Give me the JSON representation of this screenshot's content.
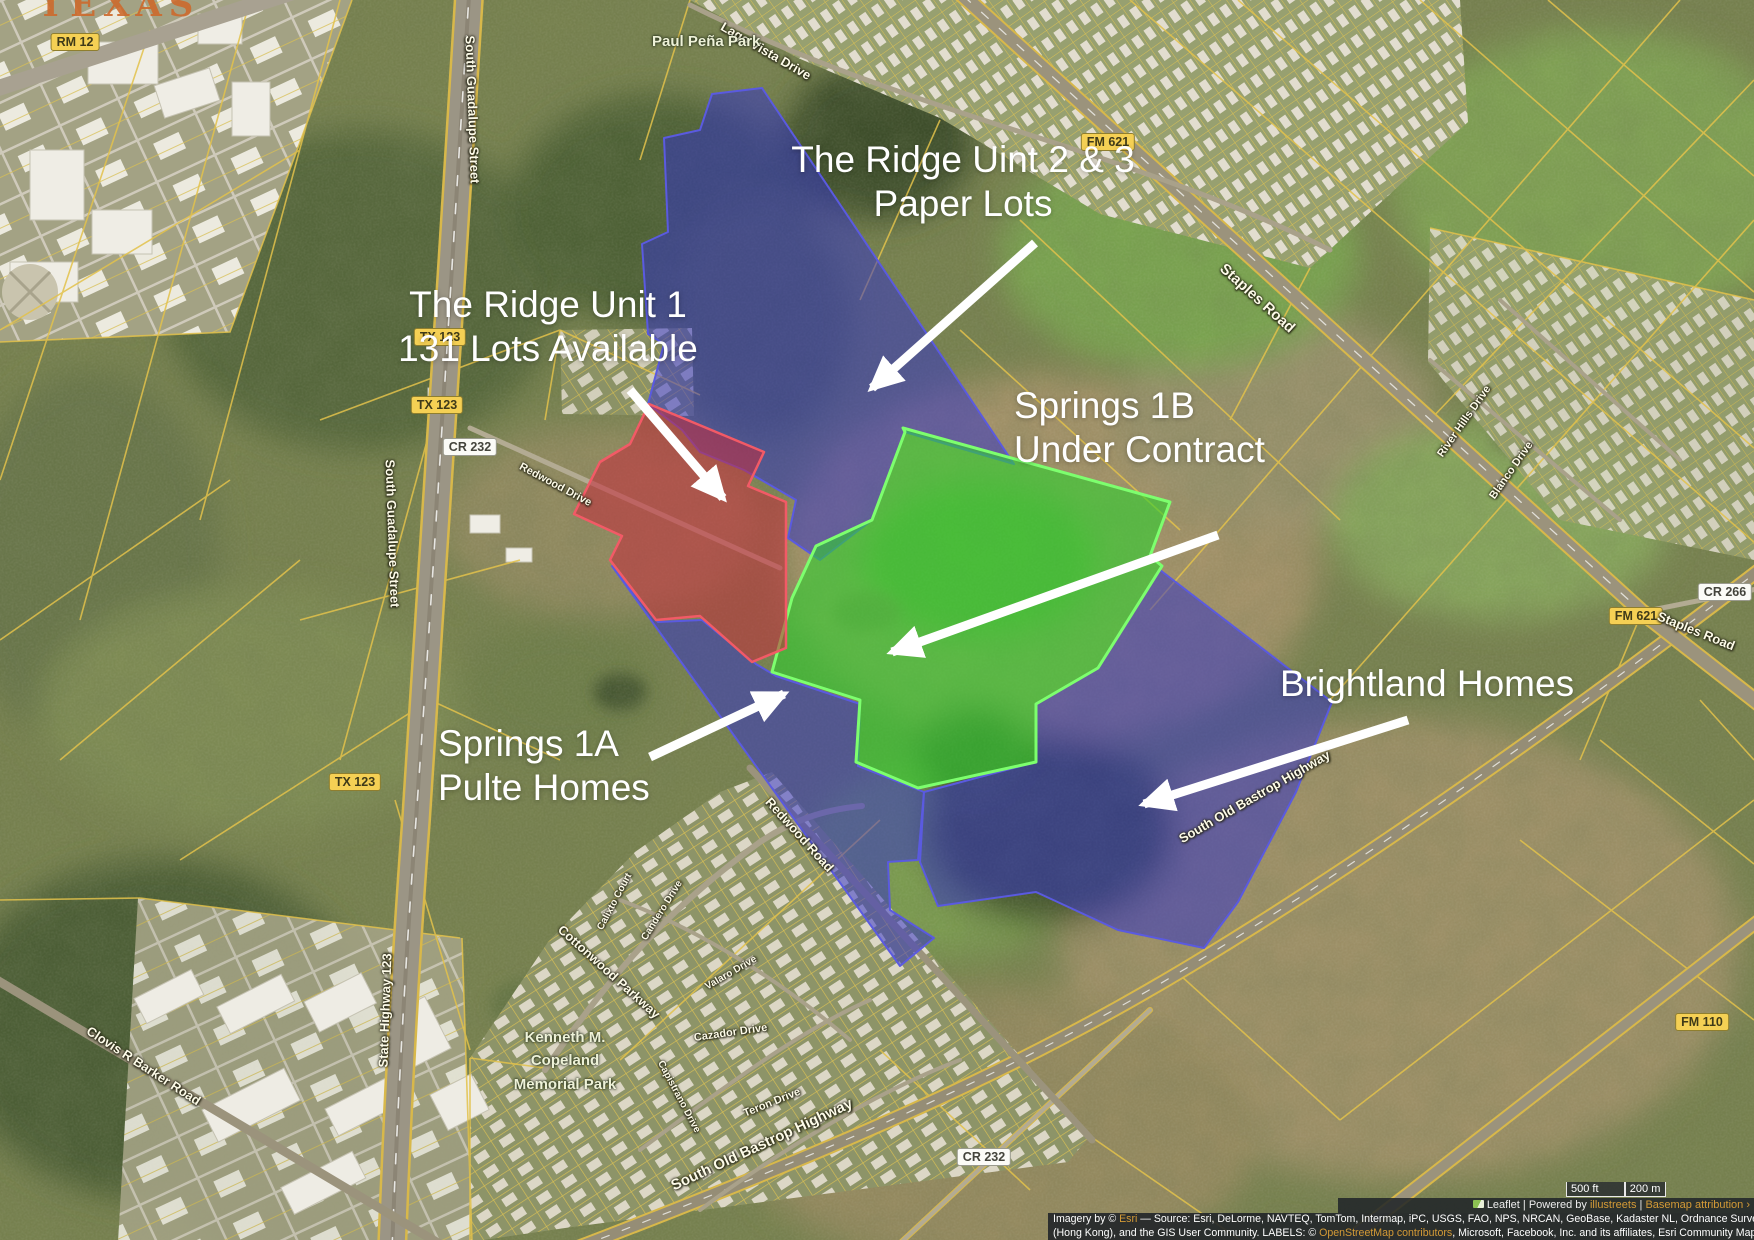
{
  "watermark": "TEXAS",
  "annotations": {
    "ridge23": {
      "line1": "The Ridge Uint 2 & 3",
      "line2": "Paper Lots"
    },
    "ridge1": {
      "line1": "The Ridge Unit 1",
      "line2": "131 Lots Available"
    },
    "springs1b": {
      "line1": "Springs 1B",
      "line2": "Under Contract"
    },
    "springs1a": {
      "line1": "Springs 1A",
      "line2": "Pulte Homes"
    },
    "brightland": {
      "line1": "Brightland Homes"
    }
  },
  "overlays": {
    "ridge23": {
      "label": "The Ridge Uint 2 & 3 Paper Lots",
      "fill": "#3232c8",
      "stroke": "#5a5ae0"
    },
    "ridge1": {
      "label": "The Ridge Unit 1 131 Lots Available",
      "fill": "#c52b3c",
      "stroke": "#f25a66"
    },
    "springs1b": {
      "label": "Springs 1B Under Contract",
      "fill": "#2ed02e",
      "stroke": "#7dff6e"
    },
    "springs1a": {
      "label": "Springs 1A Pulte Homes",
      "fill": "#3232c8",
      "stroke": "#5a5ae0"
    },
    "brightland": {
      "label": "Brightland Homes",
      "fill": "#3232c8",
      "stroke": "#5a5ae0"
    }
  },
  "colors": {
    "arrow": "#ffffff",
    "link_gold": "#d49a36",
    "parcel_line": "#e3c24b"
  },
  "shields": {
    "rm12": "RM 12",
    "tx123": "TX 123",
    "fm621": "FM 621",
    "fm110": "FM 110",
    "cr232": "CR 232",
    "cr266": "CR 266"
  },
  "streets": {
    "south_guadalupe": "South Guadalupe Street",
    "state_highway": "State Highway 123",
    "clovis": "Clovis R Barker Road",
    "old_bastrop": "South Old Bastrop Highway",
    "staples": "Staples Road",
    "lago_vista": "Lago Vista Drive",
    "river_hills": "River Hills Drive",
    "blanco": "Blanco Drive",
    "redwood_dr": "Redwood Drive",
    "redwood_rd": "Redwood Road",
    "cottonwood": "Cottonwood Parkway",
    "calixto": "Calixto Court",
    "candero": "Candero Drive",
    "valaro": "Valaro Drive",
    "cazador": "Cazador Drive",
    "capistrano": "Capistrano Drive",
    "teron": "Teron Drive"
  },
  "parks": {
    "paul_pena": "Paul Peña Park",
    "copeland1": "Kenneth M.",
    "copeland2": "Copeland",
    "copeland3": "Memorial Park"
  },
  "footer": {
    "scale_ft": "500 ft",
    "scale_m": "200 m",
    "leaflet": "Leaflet",
    "sep1": " | ",
    "powered_by": "Powered by ",
    "illustreets": "illustreets",
    "sep2": " | ",
    "basemap": "Basemap attribution ›",
    "attr1_pre": "Imagery by © ",
    "attr1_link": "Esri",
    "attr1_post": " — Source: Esri, DeLorme, NAVTEQ, TomTom, Intermap, iPC, USGS, FAO, NPS, NRCAN, GeoBase, Kadaster NL, Ordnance Survey, Esri Japan, METI, Esri China",
    "attr2_pre": "(Hong Kong), and the GIS User Community. LABELS: © ",
    "attr2_link": "OpenStreetMap contributors",
    "attr2_mid": ", Microsoft, Facebook, Inc. and its affiliates, Esri Community Maps contributors. Map layer by ",
    "attr2_link2": "Esri"
  }
}
